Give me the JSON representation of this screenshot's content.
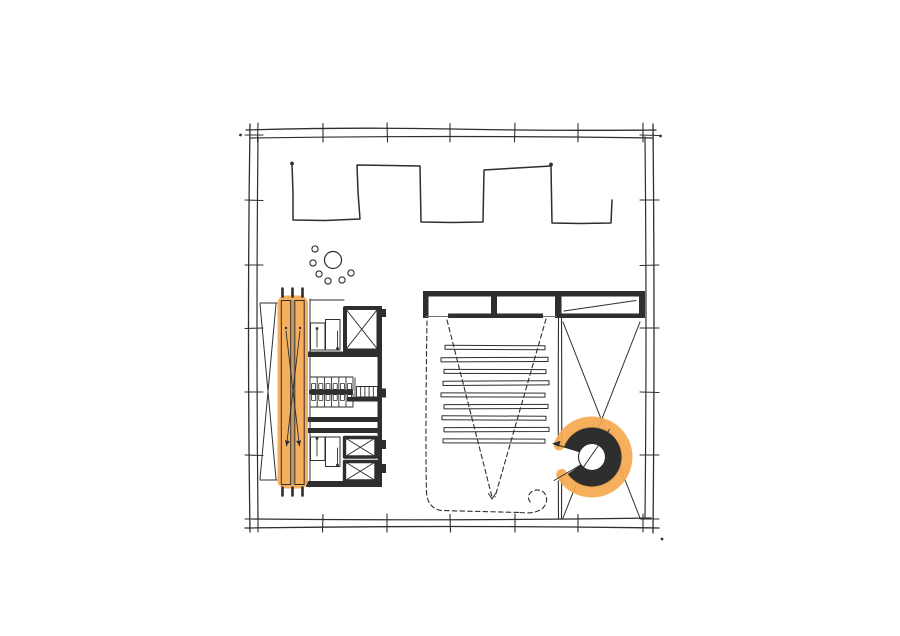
{
  "canvas": {
    "width": 900,
    "height": 636,
    "background": "#ffffff"
  },
  "palette": {
    "ink": "#2e2e2e",
    "soft": "#707070",
    "rail": "#8f8f8f",
    "highlight": "#f5a94f",
    "paper": "#ffffff"
  },
  "plan": {
    "kind": "hand-drawn architectural floor plan sketch",
    "highlight_color": "#f5a94f",
    "elements": [
      {
        "id": "outer-wall",
        "label": "double-line exterior wall with structural grid ticks"
      },
      {
        "id": "zigzag-partition-wall",
        "label": "crenellated freestanding partition wall"
      },
      {
        "id": "table-with-chairs",
        "label": "round table with six chairs"
      },
      {
        "id": "cross-braced-shaft",
        "label": "narrow x-braced shaft strip"
      },
      {
        "id": "escalator-bank",
        "label": "paired escalators highlighted in orange"
      },
      {
        "id": "service-core",
        "label": "core with two stairs, three elevators and stall block"
      },
      {
        "id": "lobby-wall-band",
        "label": "thick poche wall band with two door openings"
      },
      {
        "id": "auditorium-seating-rows",
        "label": "nine bench seating rows",
        "row_count": 9
      },
      {
        "id": "sightline-dashed-v",
        "label": "dashed projection sightline V"
      },
      {
        "id": "circulation-dashed-path",
        "label": "dashed circulation path ending in a curl"
      },
      {
        "id": "right-bay-x-brace",
        "label": "right bay with long x bracing"
      },
      {
        "id": "spiral-stair",
        "label": "spiral stair highlighted in orange"
      }
    ]
  }
}
